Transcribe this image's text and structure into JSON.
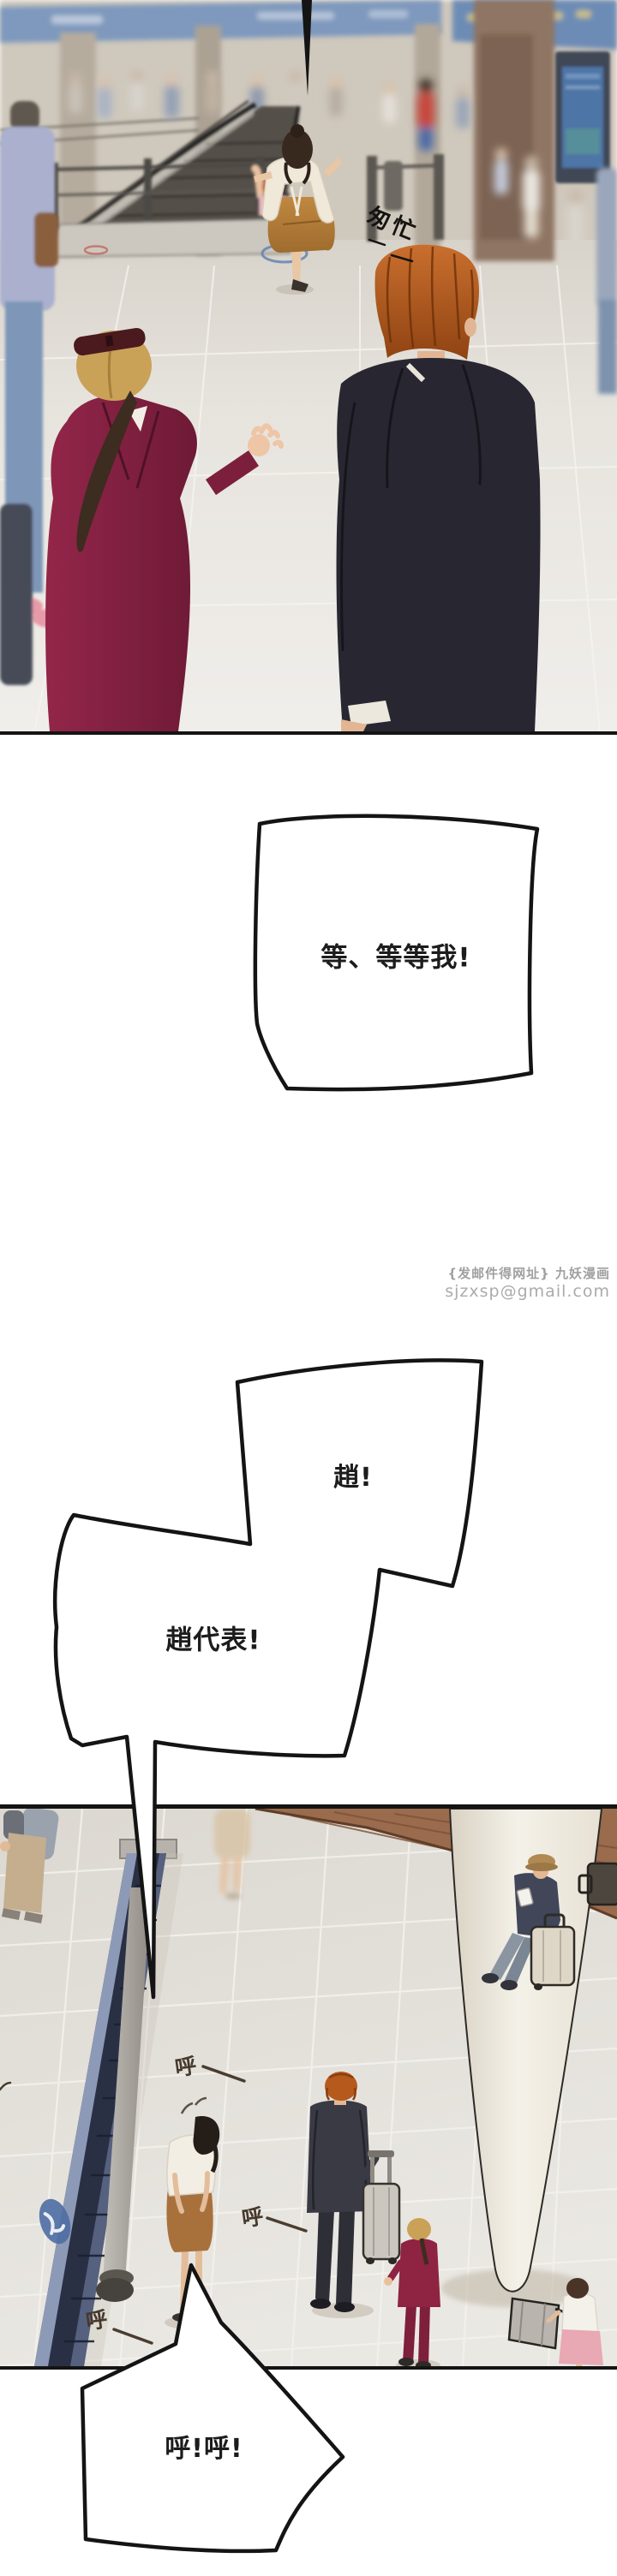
{
  "bubbles": {
    "b1": "等、等等我!",
    "b2": "趙!",
    "b3": "趙代表!",
    "b4": "呼!呼!"
  },
  "sfx": {
    "hurry": "匆忙",
    "breath": "呼"
  },
  "watermark": {
    "line1": "{发邮件得网址} 九妖漫画",
    "line2": "sjzxsp@gmail.com"
  },
  "colors": {
    "panel_border": "#141414",
    "bubble_stroke": "#141414",
    "bubble_fill": "#ffffff",
    "watermark_gray": "#a0a0a0",
    "sign_blue": "#7e99bd",
    "escalator_navy": "#2a3044",
    "suit_dark": "#282731",
    "burgundy": "#8e2342",
    "hair_orange": "#b5591d",
    "dress_camel": "#b9813f",
    "floor_gray": "#e2dfd8",
    "wood_brown": "#9a6b4c"
  }
}
